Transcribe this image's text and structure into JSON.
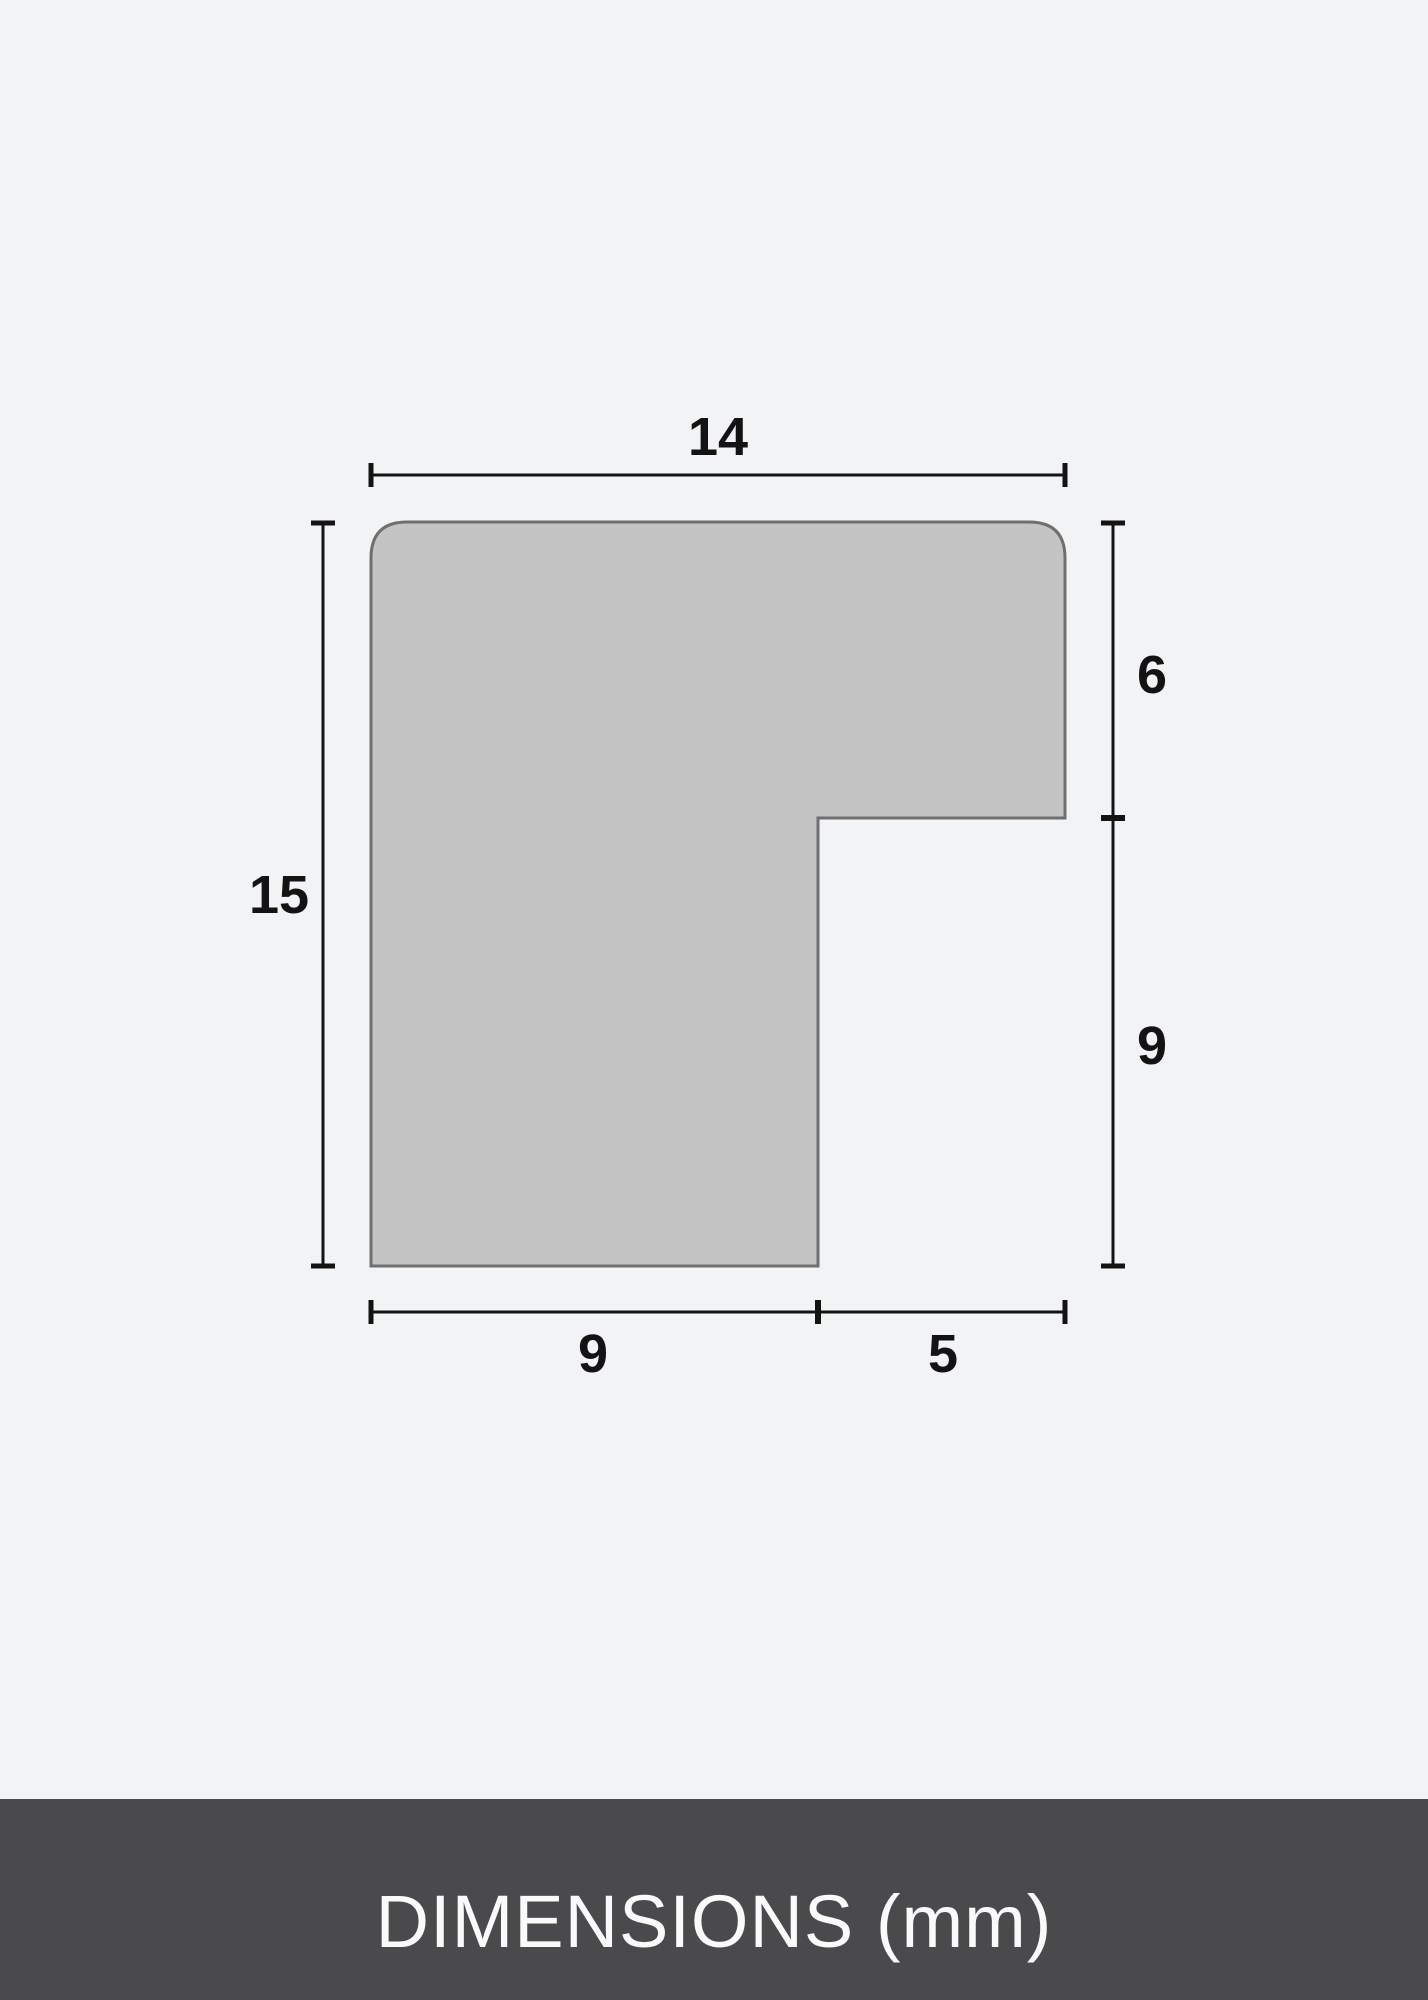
{
  "diagram": {
    "description": "Frame moulding profile cross-section with dimension lines",
    "dimensions": {
      "top_width": "14",
      "left_height": "15",
      "right_upper": "6",
      "right_lower": "9",
      "bottom_left": "9",
      "bottom_right": "5"
    }
  },
  "footer": {
    "label": "DIMENSIONS (mm)"
  },
  "colors": {
    "background": "#f2f3f5",
    "shape_fill": "#c4c4c4",
    "shape_border": "#6f6f6f",
    "dimension_line": "#131313",
    "footer_background": "#4a4a4c",
    "footer_text": "#fafafa"
  }
}
